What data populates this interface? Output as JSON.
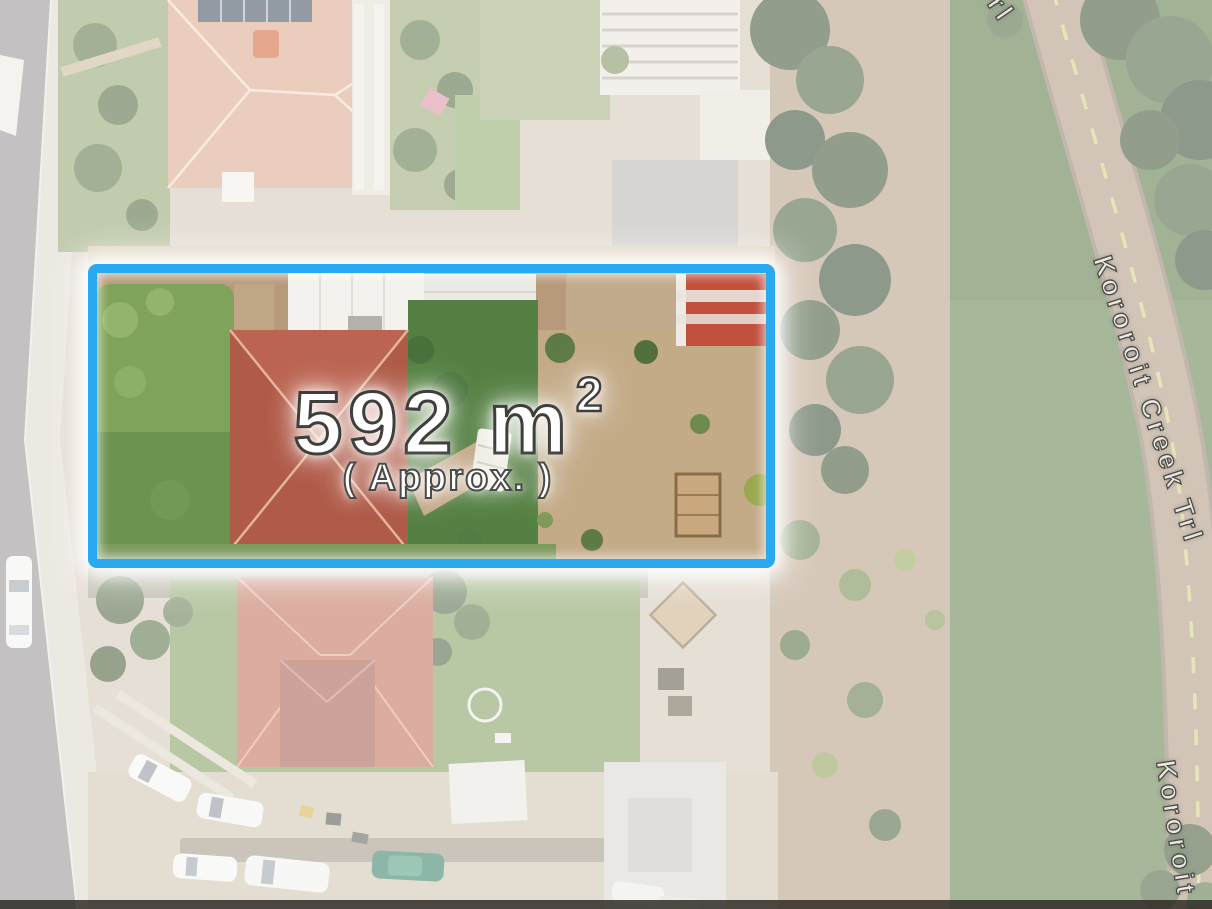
{
  "annotation": {
    "area_value": "592 m",
    "area_exponent": "2",
    "approx_label": "( Approx. )",
    "lot_outline_color": "#29a9f2",
    "glow_color": "#ffffff"
  },
  "trail": {
    "name": "Kororoit Creek Trl",
    "label_main": "Kororoit Creek Trl",
    "label_partial_top": "rl",
    "label_partial_bottom": "Kororoit C"
  }
}
